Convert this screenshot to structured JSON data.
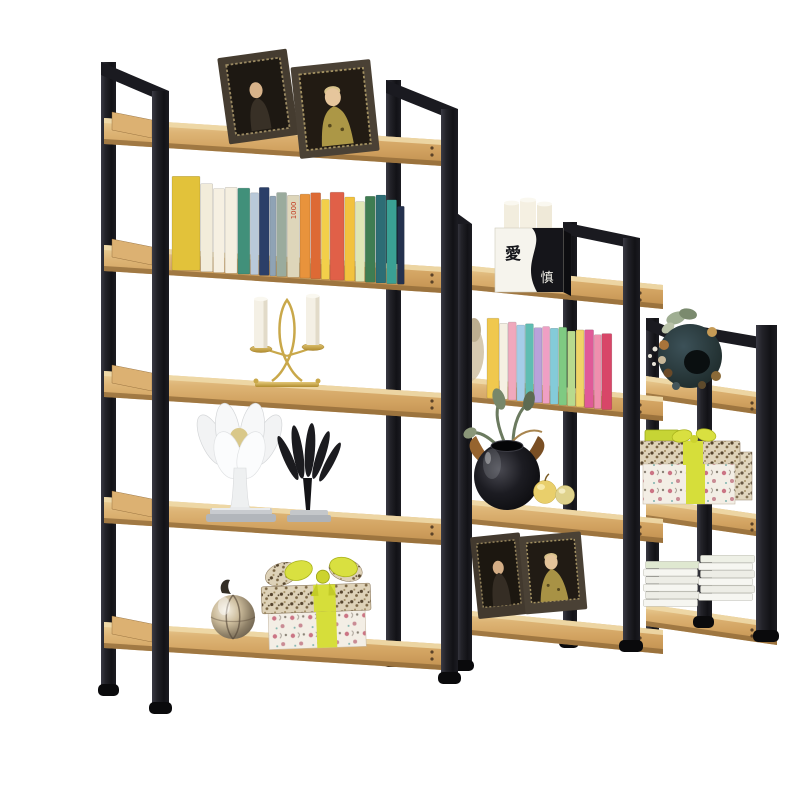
{
  "scene": {
    "type": "product-photo",
    "subject": "Staircase-style black steel and wood display bookshelf with decor",
    "background": "#ffffff"
  },
  "palette": {
    "metal_dark": "#17171c",
    "metal_light": "#3a3a44",
    "wood_light": "#ecd29b",
    "wood_mid": "#d2a361",
    "wood_dark": "#c08f4e",
    "wood_edge": "#8a6535",
    "ribbon_chartreuse": "#d6de3a",
    "gold": "#c9a84a",
    "candle_wax": "#f3efe4"
  },
  "yinyang_box": {
    "char_top": "愛",
    "char_bottom": "慎"
  },
  "units": [
    {
      "id": "left",
      "shelf_count": 5,
      "x_span": [
        104,
        458
      ],
      "shelf_planes_y": [
        118,
        245,
        371,
        497,
        622
      ],
      "tilt_px": 23
    },
    {
      "id": "middle",
      "shelf_count": 4,
      "x_span": [
        441,
        663
      ],
      "shelf_planes_y": [
        263,
        375,
        497,
        608
      ],
      "tilt_px": 22
    },
    {
      "id": "right",
      "shelf_count": 3,
      "x_span": [
        646,
        777
      ],
      "shelf_planes_y": [
        376,
        498,
        604
      ],
      "tilt_px": 19
    }
  ],
  "items": [
    {
      "shelf": "left-1",
      "name": "two dark wood photo frames with portraits"
    },
    {
      "shelf": "left-2",
      "name": "row of colorful hardcover books"
    },
    {
      "shelf": "left-3",
      "name": "gold double candelabra with two white candles"
    },
    {
      "shelf": "left-4",
      "name": "white tulip fruit bowl and black tulip sculpture"
    },
    {
      "shelf": "left-5",
      "name": "metallic ball ornament and patterned gift box with chartreuse bow"
    },
    {
      "shelf": "middle-1",
      "name": "yin-yang calligraphy box with white candles"
    },
    {
      "shelf": "middle-2",
      "name": "row of pastel paperback books with dried leaves behind"
    },
    {
      "shelf": "middle-3",
      "name": "black glossy vase with leaves and two yellow apples"
    },
    {
      "shelf": "middle-4",
      "name": "two dark wood photo frames with portraits"
    },
    {
      "shelf": "right-1",
      "name": "dark floral wreath ornament"
    },
    {
      "shelf": "right-2",
      "name": "patterned gift boxes with yellow ribbon and lime box"
    },
    {
      "shelf": "right-3",
      "name": "two stacks of white booklets"
    }
  ],
  "books_left": {
    "x_start": 172,
    "gap": 0.7,
    "surface_offset": 20,
    "plane_y": 245,
    "origin_x": 104,
    "slope": 0.065,
    "spines": [
      {
        "c": "#e2c23a",
        "w": 28,
        "h": 94
      },
      {
        "c": "#f2ecda",
        "w": 12,
        "h": 88
      },
      {
        "c": "#f6f0e2",
        "w": 11,
        "h": 84
      },
      {
        "c": "#f5efe0",
        "w": 12,
        "h": 86
      },
      {
        "c": "#41907a",
        "w": 12,
        "h": 86
      },
      {
        "c": "#b9c9d9",
        "w": 8,
        "h": 82
      },
      {
        "c": "#2b3f68",
        "w": 10,
        "h": 88
      },
      {
        "c": "#8fa3b5",
        "w": 6,
        "h": 80
      },
      {
        "c": "#9aab9d",
        "w": 10,
        "h": 84
      },
      {
        "c": "#ded6ba",
        "w": 12,
        "h": 82,
        "label": "1000",
        "label_color": "#c23b22"
      },
      {
        "c": "#e8933c",
        "w": 10,
        "h": 84
      },
      {
        "c": "#dd6a35",
        "w": 10,
        "h": 86
      },
      {
        "c": "#f2cf4a",
        "w": 8,
        "h": 80
      },
      {
        "c": "#e06048",
        "w": 14,
        "h": 88
      },
      {
        "c": "#f2c23e",
        "w": 10,
        "h": 84
      },
      {
        "c": "#dfe6b5",
        "w": 9,
        "h": 80
      },
      {
        "c": "#3f7d52",
        "w": 10,
        "h": 86
      },
      {
        "c": "#2d6d75",
        "w": 10,
        "h": 88
      },
      {
        "c": "#3aa094",
        "w": 10,
        "h": 84
      },
      {
        "c": "#24314e",
        "w": 7,
        "h": 78
      }
    ]
  },
  "books_middle": {
    "x_start": 487,
    "gap": 0.6,
    "surface_offset": 18,
    "plane_y": 375,
    "origin_x": 441,
    "slope": 0.1,
    "spines": [
      {
        "c": "#f0c84e",
        "w": 12,
        "h": 80
      },
      {
        "c": "#f5f0e2",
        "w": 8,
        "h": 76
      },
      {
        "c": "#f0a8bc",
        "w": 8,
        "h": 78
      },
      {
        "c": "#a5cde8",
        "w": 8,
        "h": 76
      },
      {
        "c": "#5fbdb2",
        "w": 8,
        "h": 78
      },
      {
        "c": "#b9a2da",
        "w": 8,
        "h": 75
      },
      {
        "c": "#ef9fc4",
        "w": 7,
        "h": 77
      },
      {
        "c": "#84cbd9",
        "w": 8,
        "h": 76
      },
      {
        "c": "#7fca82",
        "w": 8,
        "h": 78
      },
      {
        "c": "#b8da8e",
        "w": 8,
        "h": 75
      },
      {
        "c": "#f0d468",
        "w": 8,
        "h": 77
      },
      {
        "c": "#e05a98",
        "w": 9,
        "h": 78
      },
      {
        "c": "#ef8fae",
        "w": 7,
        "h": 74
      },
      {
        "c": "#d84668",
        "w": 10,
        "h": 76
      }
    ]
  },
  "booklet_stacks": [
    {
      "x": 644,
      "w": 54,
      "bottom_y": 607,
      "count": 6,
      "top_tint": "#dfe8d0"
    },
    {
      "x": 699,
      "w": 54,
      "bottom_y": 601,
      "count": 6,
      "top_tint": "#eef0e6"
    }
  ]
}
